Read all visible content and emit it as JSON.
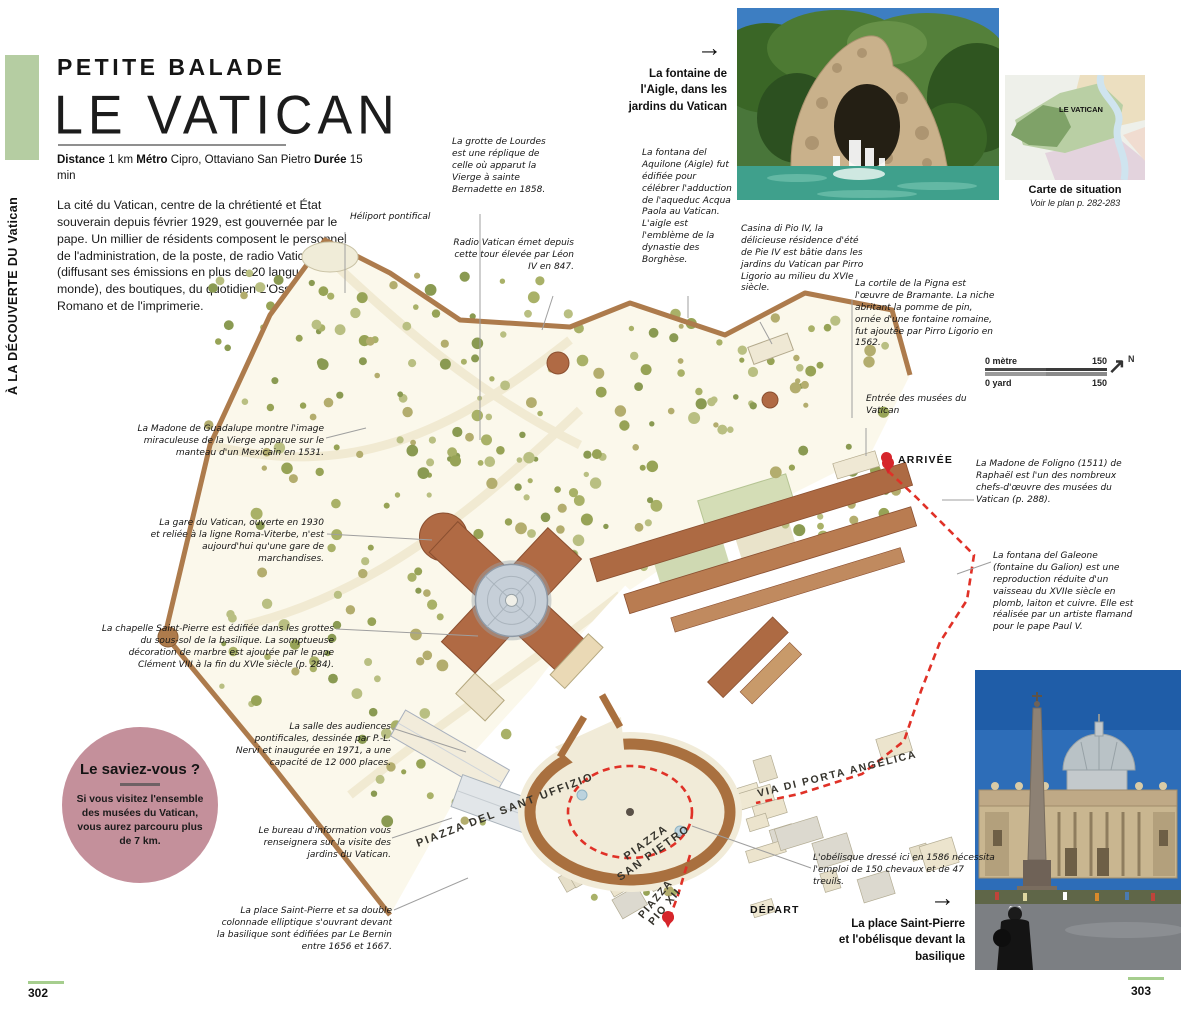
{
  "page": {
    "left_number": "302",
    "right_number": "303"
  },
  "sidebar": {
    "vertical_label": "À LA DÉCOUVERTE DU Vatican"
  },
  "header": {
    "kicker": "PETITE BALADE",
    "title": "LE VATICAN",
    "meta": [
      {
        "label": "Distance",
        "value": "1 km"
      },
      {
        "label": "Métro",
        "value": "Cipro, Ottaviano San Pietro"
      },
      {
        "label": "Durée",
        "value": "15 min"
      }
    ],
    "intro": "La cité du Vatican, centre de la chrétienté et État souverain depuis février 1929, est gouvernée par le pape. Un millier de résidents composent le personnel de l'administration, de la poste, de radio Vatican (diffusant ses émissions en plus de 20 langues dans le monde), des boutiques, du quotidien L'Osservatore Romano et de l'imprimerie."
  },
  "photo_top": {
    "arrow": "→",
    "caption": "La fontaine de l'Aigle, dans les jardins du Vatican"
  },
  "situation_map": {
    "region_label": "LE VATICAN",
    "caption": "Carte de situation",
    "subcaption": "Voir le plan p. 282-283"
  },
  "scale_bar": {
    "top_label": "0 mètre",
    "top_value": "150",
    "bottom_label": "0 yard",
    "bottom_value": "150",
    "north": "N"
  },
  "map": {
    "labels": {
      "piazza_uffizio": "PIAZZA DEL SANT UFFIZIO",
      "piazza_line1": "PIAZZA",
      "piazza_line2": "SAN PIETRO",
      "pio_line1": "PIAZZA",
      "pio_line2": "PIO XII",
      "via_angelica": "VIA DI PORTA ANGELICA"
    },
    "markers": {
      "arrivee": "ARRIVÉE",
      "depart": "DÉPART"
    }
  },
  "annotations": [
    {
      "id": "heliport",
      "text": "Héliport pontifical"
    },
    {
      "id": "grotte",
      "text": "La grotte de Lourdes est une réplique de celle où apparut la Vierge à sainte Bernadette en 1858."
    },
    {
      "id": "radio",
      "text": "Radio Vatican émet depuis cette tour élevée par Léon IV en 847."
    },
    {
      "id": "aquilone",
      "text": "La fontana del Aquilone (Aigle) fut édifiée pour célébrer l'adduction de l'aqueduc Acqua Paola au Vatican. L'aigle est l'emblème de la dynastie des Borghèse."
    },
    {
      "id": "casina",
      "text": "Casina di Pio IV, la délicieuse résidence d'été de Pie IV est bâtie dans les jardins du Vatican par Pirro Ligorio au milieu du XVIe siècle."
    },
    {
      "id": "pigna",
      "text": "La cortile de la Pigna est l'œuvre de Bramante. La niche abritant la pomme de pin, ornée d'une fontaine romaine, fut ajoutée par Pirro Ligorio en 1562."
    },
    {
      "id": "entree",
      "text": "Entrée des musées du Vatican"
    },
    {
      "id": "guadalupe",
      "text": "La Madone de Guadalupe montre l'image miraculeuse de la Vierge apparue sur le manteau d'un Mexicain en 1531."
    },
    {
      "id": "gare",
      "text": "La gare du Vatican, ouverte en 1930 et reliée à la ligne Roma-Viterbe, n'est aujourd'hui qu'une gare de marchandises."
    },
    {
      "id": "chapelle",
      "text": "La chapelle Saint-Pierre est édifiée dans les grottes du sous-sol de la basilique. La somptueuse décoration de marbre est ajoutée par le pape Clément VIII à la fin du XVIe siècle (p. 284)."
    },
    {
      "id": "salle",
      "text": "La salle des audiences pontificales, dessinée par P.-L. Nervi et inaugurée en 1971, a une capacité de 12 000 places."
    },
    {
      "id": "bureau",
      "text": "Le bureau d'information vous renseignera sur la visite des jardins du Vatican."
    },
    {
      "id": "place",
      "text": "La place Saint-Pierre et sa double colonnade elliptique s'ouvrant devant la basilique sont édifiées par Le Bernin entre 1656 et 1667."
    },
    {
      "id": "foligno",
      "text": "La Madone de Foligno (1511) de Raphaël est l'un des nombreux chefs-d'œuvre des musées du Vatican (p. 288)."
    },
    {
      "id": "galeone",
      "text": "La fontana del Galeone (fontaine du Galion) est une reproduction réduite d'un vaisseau du XVIIe siècle en plomb, laiton et cuivre. Elle est réalisée par un artiste flamand pour le pape Paul V."
    },
    {
      "id": "obelisque",
      "text": "L'obélisque dressé ici en 1586 nécessita l'emploi de 150 chevaux et de 47 treuils."
    }
  ],
  "didyouknow": {
    "title": "Le saviez-vous ?",
    "body": "Si vous visitez l'ensemble des musées du Vatican, vous aurez parcouru plus de 7 km."
  },
  "photo_bottom": {
    "arrow": "→",
    "caption": "La place Saint-Pierre et l'obélisque devant la basilique"
  }
}
